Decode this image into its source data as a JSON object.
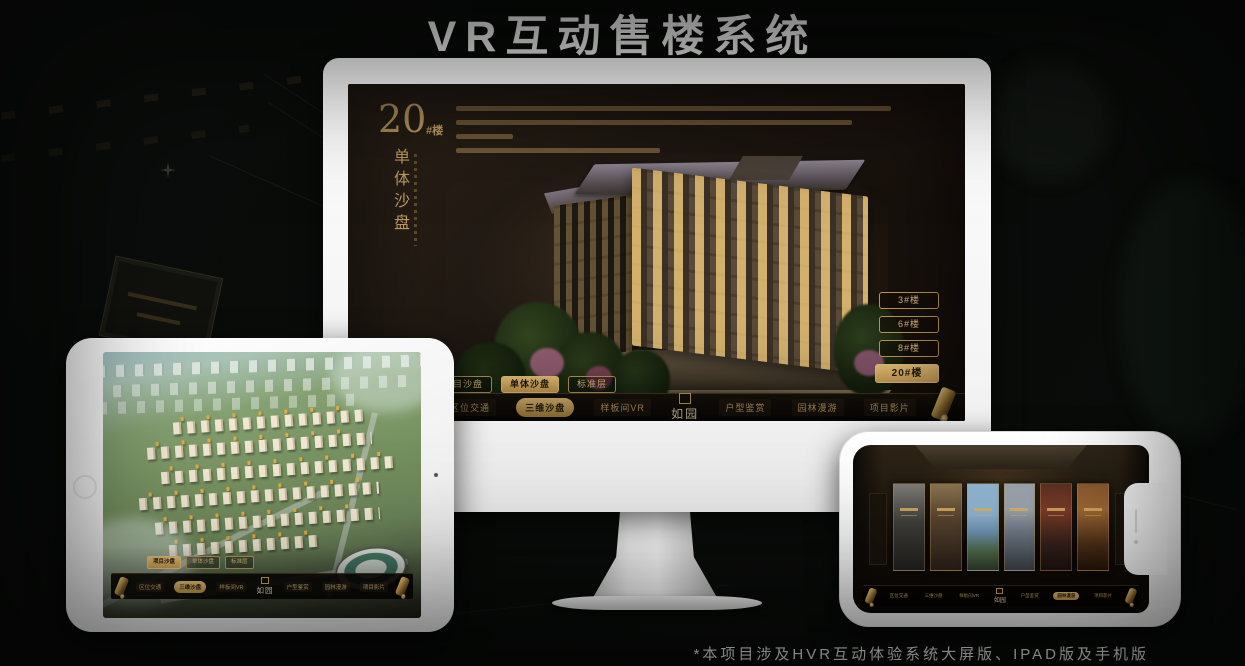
{
  "page": {
    "title": "VR互动售楼系统",
    "footnote": "*本项目涉及HVR互动体验系统大屏版、IPAD版及手机版"
  },
  "colors": {
    "accent_gold": "#c9a469",
    "highlight_gold": "#d9b36a",
    "screen_background": "#1d1611",
    "dark_text": "#241b10"
  },
  "brand": {
    "logo_text": "如园"
  },
  "nav": {
    "items": [
      {
        "label": "区位交通"
      },
      {
        "label": "三维沙盘"
      },
      {
        "label": "样板间VR"
      },
      {
        "label": "户型鉴赏"
      },
      {
        "label": "园林漫游"
      },
      {
        "label": "项目影片"
      }
    ]
  },
  "monitor": {
    "headline": {
      "number": "20",
      "suffix": "#楼",
      "vertical": "单体沙盘"
    },
    "floor_buttons": [
      {
        "label": "3#楼"
      },
      {
        "label": "6#楼"
      },
      {
        "label": "8#楼"
      },
      {
        "label": "20#楼"
      }
    ],
    "active_floor": "20#楼",
    "sub_tabs": [
      {
        "label": "项目沙盘"
      },
      {
        "label": "单体沙盘"
      },
      {
        "label": "标准层"
      }
    ],
    "active_sub_tab": "单体沙盘",
    "active_nav": "三维沙盘"
  },
  "tablet": {
    "sub_tabs": [
      {
        "label": "项目沙盘"
      },
      {
        "label": "单体沙盘"
      },
      {
        "label": "标准层"
      }
    ],
    "active_sub_tab": "项目沙盘",
    "active_nav": "三维沙盘"
  },
  "phone": {
    "active_nav": "园林漫游"
  }
}
